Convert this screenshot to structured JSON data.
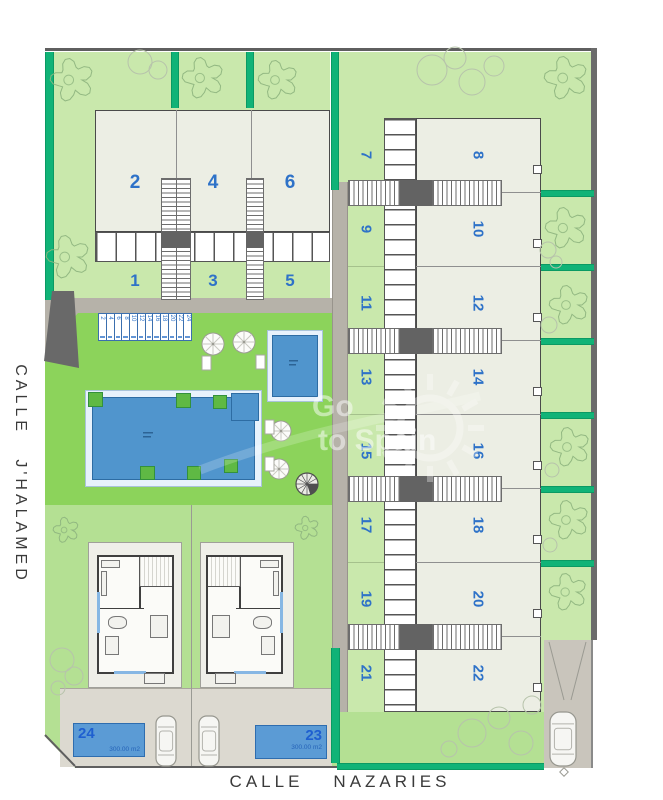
{
  "streets": {
    "left": "CALLE J'HALAMED",
    "bottom": [
      "CALLE",
      "NAZARIES"
    ]
  },
  "watermark": {
    "line1": "Go",
    "line2": "to Spain"
  },
  "left_block": {
    "upper_units": [
      "2",
      "4",
      "6"
    ],
    "lower_gardens": [
      "1",
      "3",
      "5"
    ]
  },
  "right_block": {
    "rows": [
      {
        "garden": "7",
        "house": "8"
      },
      {
        "garden": "9",
        "house": "10"
      },
      {
        "garden": "11",
        "house": "12"
      },
      {
        "garden": "13",
        "house": "14"
      },
      {
        "garden": "15",
        "house": "16"
      },
      {
        "garden": "17",
        "house": "18"
      },
      {
        "garden": "19",
        "house": "20"
      },
      {
        "garden": "21",
        "house": "22"
      }
    ]
  },
  "parking_stalls": [
    "2",
    "4",
    "6",
    "8",
    "10",
    "12",
    "14",
    "16",
    "18",
    "20",
    "22",
    "24"
  ],
  "plots": [
    {
      "number": "24",
      "area": "300.00 m2"
    },
    {
      "number": "23",
      "area": "300.00 m2"
    }
  ],
  "colors": {
    "unit_number": "#2e72c8",
    "hedge": "#10b377",
    "lawn": "#8cd35b",
    "garden": "#c9e8ac",
    "pool_water": "#5095cd",
    "plot_fill": "#5b9bd5"
  }
}
